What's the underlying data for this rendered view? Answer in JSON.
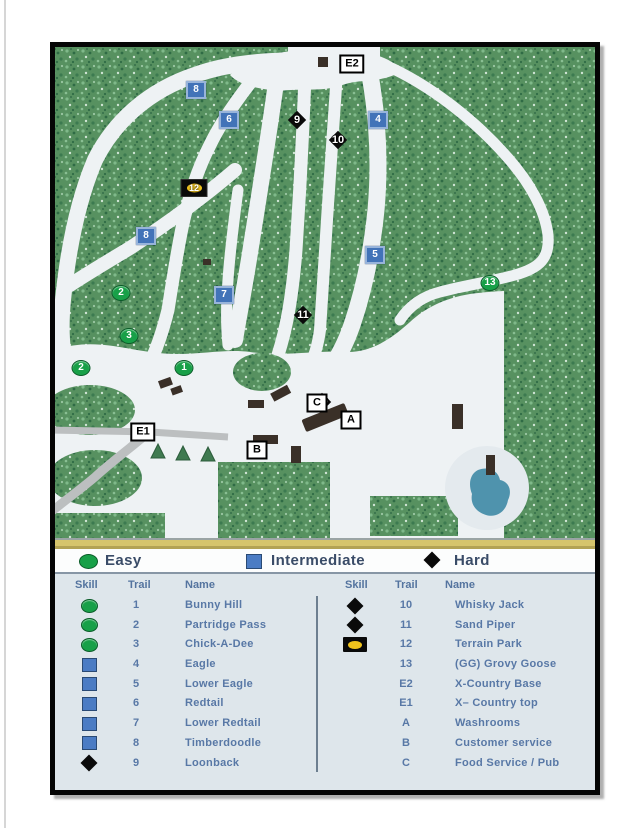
{
  "legend": {
    "items": [
      {
        "type": "easy",
        "label": "Easy"
      },
      {
        "type": "intermediate",
        "label": "Intermediate"
      },
      {
        "type": "hard",
        "label": "Hard"
      }
    ]
  },
  "trail_table": {
    "headers": [
      "Skill",
      "Trail",
      "Name"
    ],
    "left_rows": [
      {
        "skill": "easy",
        "trail": "1",
        "name": "Bunny Hill"
      },
      {
        "skill": "easy",
        "trail": "2",
        "name": "Partridge Pass"
      },
      {
        "skill": "easy",
        "trail": "3",
        "name": "Chick-A-Dee"
      },
      {
        "skill": "intermediate",
        "trail": "4",
        "name": "Eagle"
      },
      {
        "skill": "intermediate",
        "trail": "5",
        "name": "Lower Eagle"
      },
      {
        "skill": "intermediate",
        "trail": "6",
        "name": "Redtail"
      },
      {
        "skill": "intermediate",
        "trail": "7",
        "name": "Lower Redtail"
      },
      {
        "skill": "intermediate",
        "trail": "8",
        "name": "Timberdoodle"
      },
      {
        "skill": "hard",
        "trail": "9",
        "name": "Loonback"
      }
    ],
    "right_rows": [
      {
        "skill": "hard",
        "trail": "10",
        "name": "Whisky Jack"
      },
      {
        "skill": "hard",
        "trail": "11",
        "name": "Sand Piper"
      },
      {
        "skill": "terrain-park",
        "trail": "12",
        "name": "Terrain Park"
      },
      {
        "skill": "none",
        "trail": "13",
        "name": "(GG) Grovy Goose"
      },
      {
        "skill": "none",
        "trail": "E2",
        "name": "X-Country Base"
      },
      {
        "skill": "none",
        "trail": "E1",
        "name": "X– Country top"
      },
      {
        "skill": "none",
        "trail": "A",
        "name": "Washrooms"
      },
      {
        "skill": "none",
        "trail": "B",
        "name": "Customer service"
      },
      {
        "skill": "none",
        "trail": "C",
        "name": "Food Service / Pub"
      }
    ]
  },
  "map": {
    "markers": [
      {
        "type": "location",
        "label": "E2",
        "x": 352,
        "y": 64
      },
      {
        "type": "intermediate",
        "label": "8",
        "x": 196,
        "y": 90
      },
      {
        "type": "intermediate",
        "label": "6",
        "x": 229,
        "y": 120
      },
      {
        "type": "hard",
        "label": "9",
        "x": 297,
        "y": 120
      },
      {
        "type": "hard",
        "label": "10",
        "x": 338,
        "y": 120
      },
      {
        "type": "intermediate",
        "label": "4",
        "x": 378,
        "y": 120
      },
      {
        "type": "terrain-park",
        "label": "12",
        "x": 194,
        "y": 148
      },
      {
        "type": "intermediate",
        "label": "8",
        "x": 146,
        "y": 236
      },
      {
        "type": "hard",
        "label": "11",
        "x": 303,
        "y": 257
      },
      {
        "type": "intermediate",
        "label": "5",
        "x": 375,
        "y": 255
      },
      {
        "type": "easy",
        "label": "13",
        "x": 490,
        "y": 283
      },
      {
        "type": "easy",
        "label": "2",
        "x": 121,
        "y": 293
      },
      {
        "type": "intermediate",
        "label": "7",
        "x": 224,
        "y": 295
      },
      {
        "type": "hard",
        "label": "10",
        "x": 322,
        "y": 324
      },
      {
        "type": "easy",
        "label": "3",
        "x": 129,
        "y": 336
      },
      {
        "type": "easy",
        "label": "2",
        "x": 81,
        "y": 368
      },
      {
        "type": "easy",
        "label": "1",
        "x": 184,
        "y": 368
      },
      {
        "type": "location",
        "label": "C",
        "x": 317,
        "y": 403
      },
      {
        "type": "location",
        "label": "A",
        "x": 351,
        "y": 420
      },
      {
        "type": "location",
        "label": "E1",
        "x": 143,
        "y": 432
      },
      {
        "type": "location",
        "label": "B",
        "x": 257,
        "y": 450
      }
    ]
  },
  "colors": {
    "easy": "#18a048",
    "intermediate": "#4273b8",
    "hard": "#0a0a0a",
    "terrain_park_accent": "#f2c41d",
    "table_text": "#5878a6",
    "legend_text": "#3a4c68",
    "gold_band": "#d6c46c",
    "forest": "#579160",
    "pond": "#4f93ad"
  }
}
